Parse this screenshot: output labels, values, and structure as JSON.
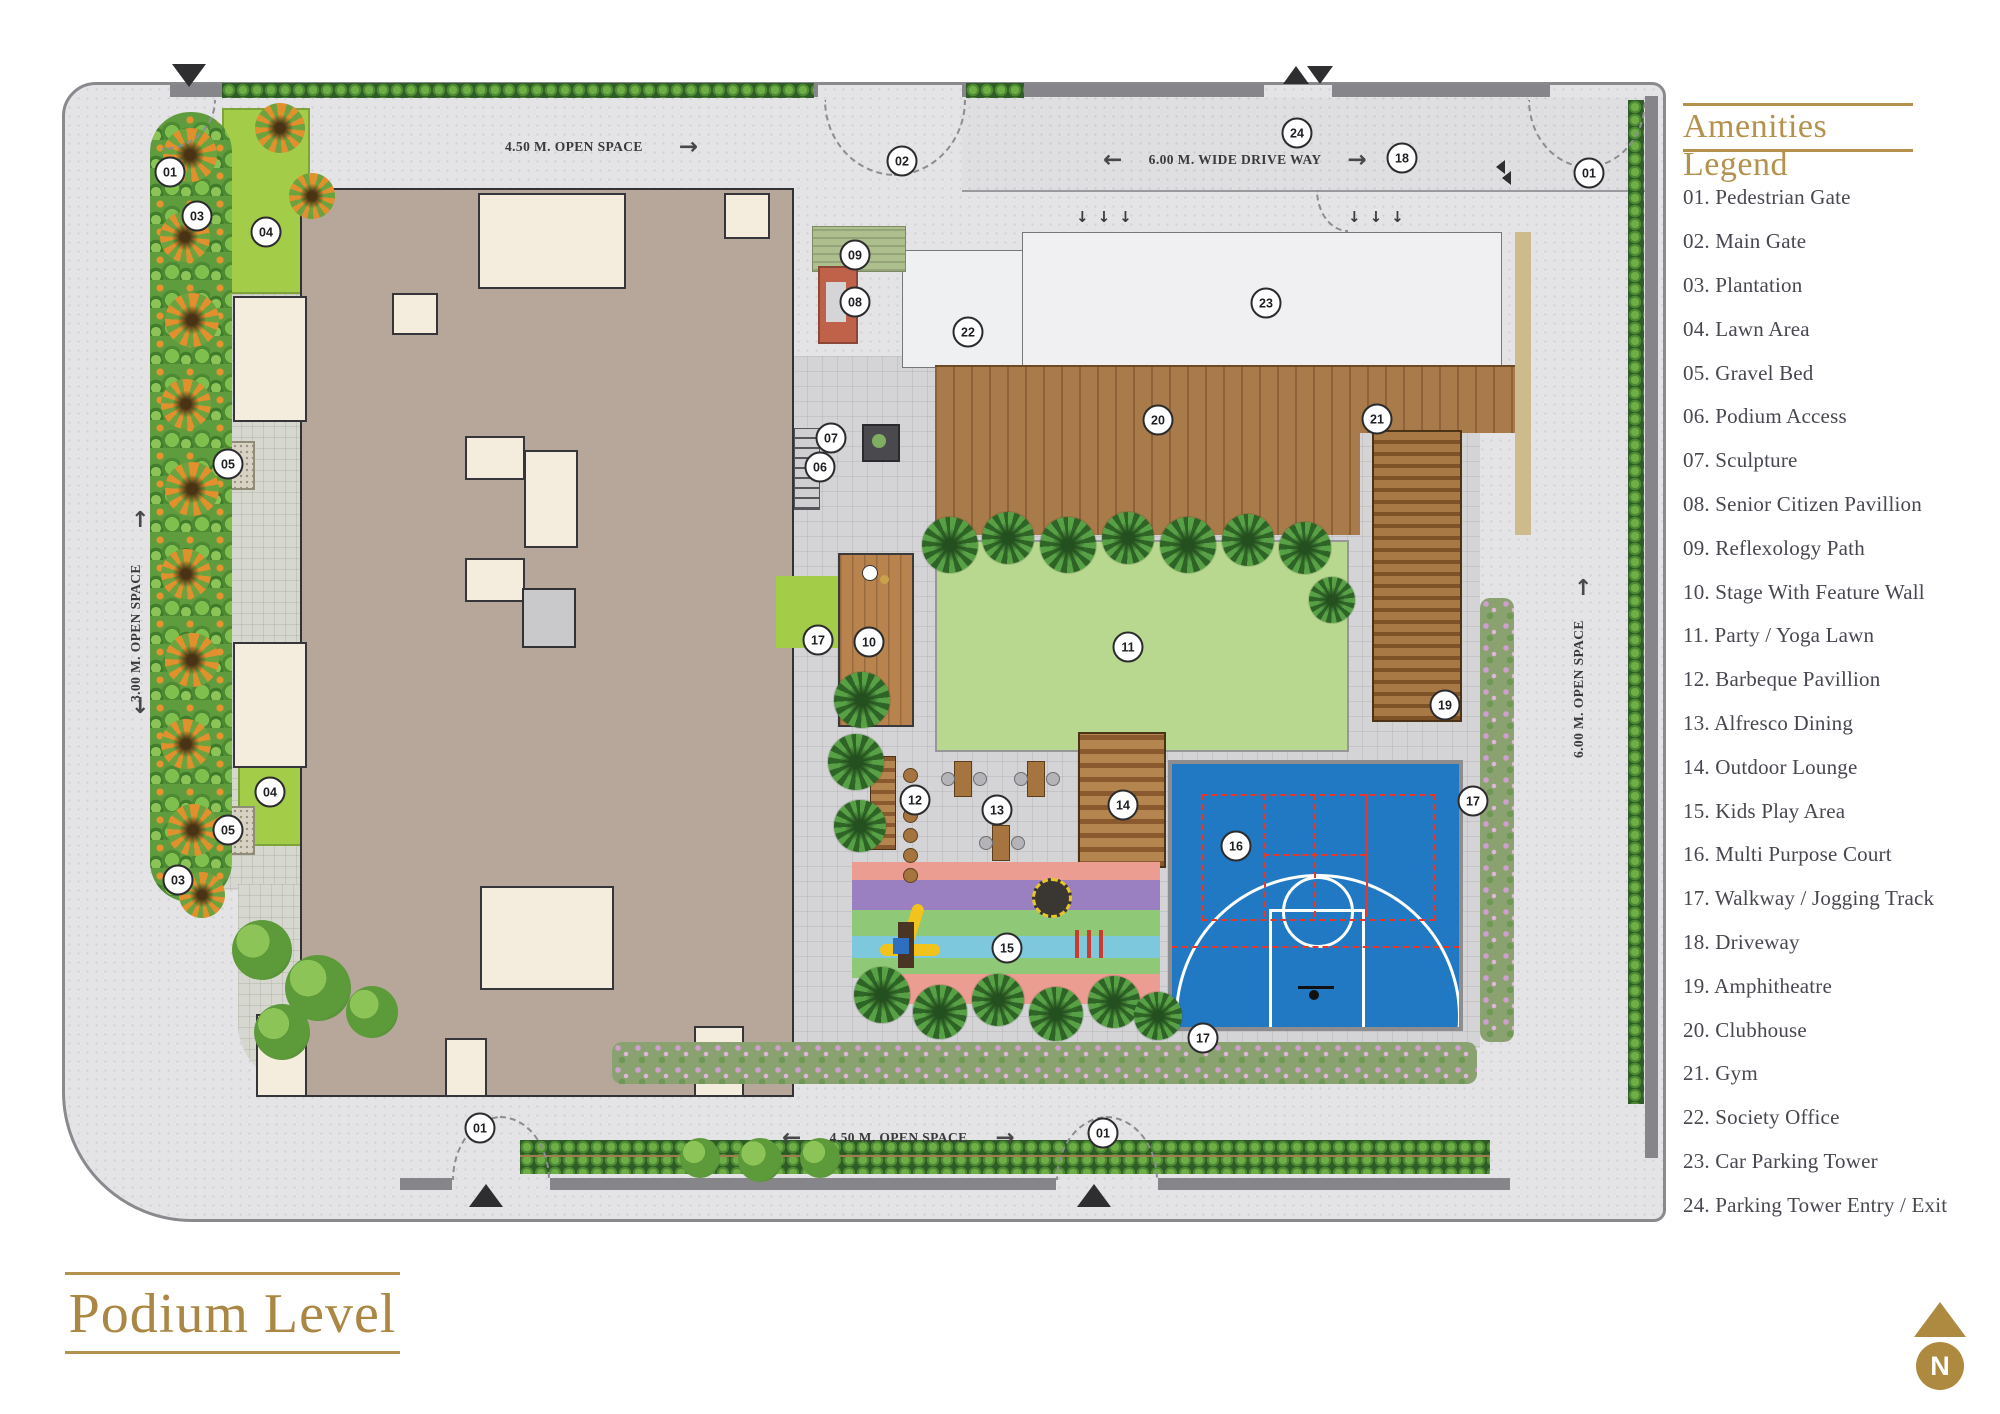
{
  "titles": {
    "plan_title": "Podium Level",
    "legend_title": "Amenities Legend"
  },
  "legend": {
    "items": [
      {
        "num": "01",
        "label": "Pedestrian Gate"
      },
      {
        "num": "02",
        "label": "Main Gate"
      },
      {
        "num": "03",
        "label": "Plantation"
      },
      {
        "num": "04",
        "label": "Lawn Area"
      },
      {
        "num": "05",
        "label": "Gravel Bed"
      },
      {
        "num": "06",
        "label": "Podium Access"
      },
      {
        "num": "07",
        "label": "Sculpture"
      },
      {
        "num": "08",
        "label": "Senior Citizen Pavillion"
      },
      {
        "num": "09",
        "label": "Reflexology Path"
      },
      {
        "num": "10",
        "label": "Stage With Feature Wall"
      },
      {
        "num": "11",
        "label": "Party / Yoga Lawn"
      },
      {
        "num": "12",
        "label": "Barbeque Pavillion"
      },
      {
        "num": "13",
        "label": "Alfresco Dining"
      },
      {
        "num": "14",
        "label": "Outdoor Lounge"
      },
      {
        "num": "15",
        "label": "Kids Play Area"
      },
      {
        "num": "16",
        "label": "Multi Purpose Court"
      },
      {
        "num": "17",
        "label": "Walkway / Jogging Track"
      },
      {
        "num": "18",
        "label": "Driveway"
      },
      {
        "num": "19",
        "label": "Amphitheatre"
      },
      {
        "num": "20",
        "label": "Clubhouse"
      },
      {
        "num": "21",
        "label": "Gym"
      },
      {
        "num": "22",
        "label": "Society Office"
      },
      {
        "num": "23",
        "label": "Car Parking Tower"
      },
      {
        "num": "24",
        "label": "Parking Tower Entry / Exit"
      }
    ]
  },
  "plan": {
    "labels": {
      "top_open_space": "4.50 M. OPEN SPACE",
      "drive_way": "6.00 M. WIDE DRIVE WAY",
      "left_open_space": "3.00 M. OPEN SPACE",
      "right_open_space": "6.00 M. OPEN SPACE",
      "bottom_open_space": "4.50 M. OPEN SPACE"
    },
    "north_label": "N",
    "badges": [
      {
        "n": "01",
        "x": 170,
        "y": 172
      },
      {
        "n": "03",
        "x": 197,
        "y": 216
      },
      {
        "n": "04",
        "x": 266,
        "y": 232
      },
      {
        "n": "02",
        "x": 902,
        "y": 161
      },
      {
        "n": "24",
        "x": 1297,
        "y": 133
      },
      {
        "n": "18",
        "x": 1402,
        "y": 158
      },
      {
        "n": "01",
        "x": 1589,
        "y": 173
      },
      {
        "n": "09",
        "x": 855,
        "y": 255
      },
      {
        "n": "08",
        "x": 855,
        "y": 302
      },
      {
        "n": "22",
        "x": 968,
        "y": 332
      },
      {
        "n": "23",
        "x": 1266,
        "y": 303
      },
      {
        "n": "20",
        "x": 1158,
        "y": 420
      },
      {
        "n": "21",
        "x": 1377,
        "y": 419
      },
      {
        "n": "07",
        "x": 831,
        "y": 438
      },
      {
        "n": "06",
        "x": 820,
        "y": 467
      },
      {
        "n": "05",
        "x": 228,
        "y": 464
      },
      {
        "n": "17",
        "x": 818,
        "y": 640
      },
      {
        "n": "10",
        "x": 869,
        "y": 642
      },
      {
        "n": "11",
        "x": 1128,
        "y": 647
      },
      {
        "n": "19",
        "x": 1445,
        "y": 705
      },
      {
        "n": "12",
        "x": 915,
        "y": 800
      },
      {
        "n": "13",
        "x": 997,
        "y": 810
      },
      {
        "n": "14",
        "x": 1123,
        "y": 805
      },
      {
        "n": "16",
        "x": 1236,
        "y": 846
      },
      {
        "n": "17",
        "x": 1473,
        "y": 801
      },
      {
        "n": "04",
        "x": 270,
        "y": 792
      },
      {
        "n": "05",
        "x": 228,
        "y": 830
      },
      {
        "n": "03",
        "x": 178,
        "y": 880
      },
      {
        "n": "15",
        "x": 1007,
        "y": 948
      },
      {
        "n": "17",
        "x": 1203,
        "y": 1038
      },
      {
        "n": "01",
        "x": 480,
        "y": 1128
      },
      {
        "n": "01",
        "x": 1103,
        "y": 1133
      }
    ]
  },
  "colors": {
    "accent_gold": "#b5914e",
    "court_blue": "#2079c2",
    "court_line_red": "#e8372a",
    "lawn_green": "#a3cc49",
    "party_lawn_green": "#b9d88f",
    "deck_brown": "#a97a4a",
    "building_tan": "#b7a79a",
    "building_cream": "#f4ecdc",
    "pavilion_rust": "#c0614a",
    "legend_text": "#474750"
  }
}
